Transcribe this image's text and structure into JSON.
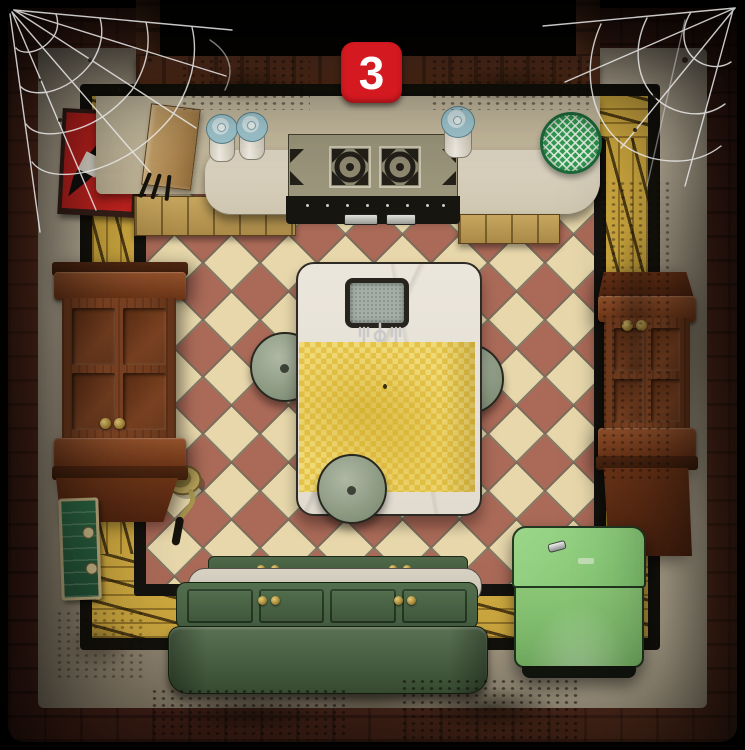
{
  "scene": {
    "description": "Top-down escape-room kitchen scene with checkered tile floor",
    "badge": {
      "number": "3"
    }
  },
  "colors": {
    "badge_bg": "#d41920",
    "badge_text": "#ffffff",
    "outer_frame_brick": "#50271c",
    "wall_plaster": "#c6bba2",
    "floor_border_brick": "#d0aa40",
    "floor_tile_terracotta": "#ab6a58",
    "floor_tile_cream": "#e7d7ab",
    "door_wood": "#7d4425",
    "knob_brass": "#c9a84c",
    "counter_beige": "#c7bca0",
    "counter_marble": "#d6ceba",
    "stove_top_olive": "#9b957b",
    "canister_lid_blue": "#a5ccd4",
    "sieve_green": "#35a057",
    "poster_red": "#c62420",
    "tablecloth_yellow": "#e9cb54",
    "stool_sage": "#9aa68f",
    "cabinet_green_dark": "#4f6b49",
    "chest_green_light": "#8acb77",
    "wall_panel_green": "#2f6b46"
  },
  "objects": [
    "stage-badge",
    "doorway-top",
    "spider-web-left",
    "spider-web-right",
    "red-poster",
    "utensil-box",
    "canister-1",
    "canister-2",
    "canister-3",
    "stove",
    "sieve",
    "kitchen-counter",
    "left-door",
    "right-door",
    "green-wall-panel",
    "dining-table",
    "slate-tray",
    "forks",
    "tablecloth",
    "stool-left",
    "stool-right",
    "stool-bottom",
    "ladle",
    "bench-cabinet",
    "chest-freezer"
  ]
}
